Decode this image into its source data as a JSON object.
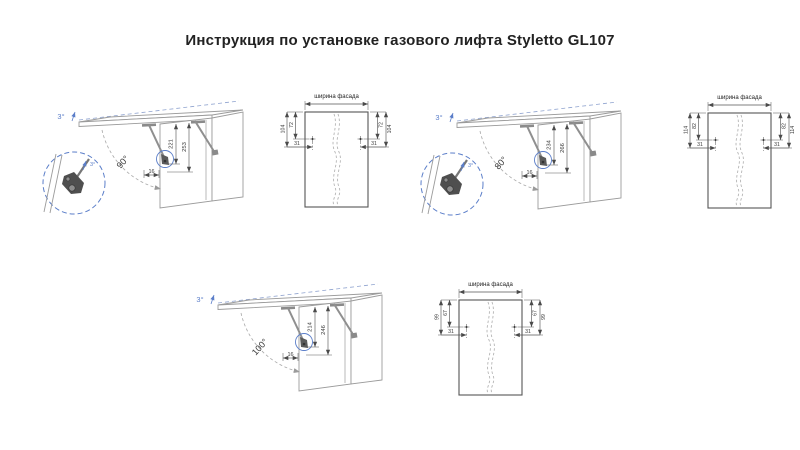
{
  "title": "Инструкция  по установке газового лифта Styletto GL107",
  "colors": {
    "accent_blue": "#5b7ec9",
    "drawing_line_gray": "#9b9b9b",
    "dimension_dark": "#3a3a3a"
  },
  "panels": [
    {
      "name": "opening-90",
      "tilt_label": "3°",
      "angle_label": "90°",
      "dim_inner": "221",
      "dim_outer": "253",
      "dim_offset": "16",
      "facade": {
        "title": "ширина фасада",
        "dim_outer": "104",
        "dim_inner": "72",
        "dim_side": "31"
      }
    },
    {
      "name": "opening-80",
      "tilt_label": "3°",
      "angle_label": "80°",
      "dim_inner": "234",
      "dim_outer": "266",
      "dim_offset": "16",
      "facade": {
        "title": "ширина фасада",
        "dim_outer": "114",
        "dim_inner": "82",
        "dim_side": "31"
      }
    },
    {
      "name": "opening-100",
      "tilt_label": "3°",
      "angle_label": "100°",
      "dim_inner": "214",
      "dim_outer": "246",
      "dim_offset": "16",
      "facade": {
        "title": "ширина фасада",
        "dim_outer": "99",
        "dim_inner": "67",
        "dim_side": "31"
      }
    }
  ]
}
